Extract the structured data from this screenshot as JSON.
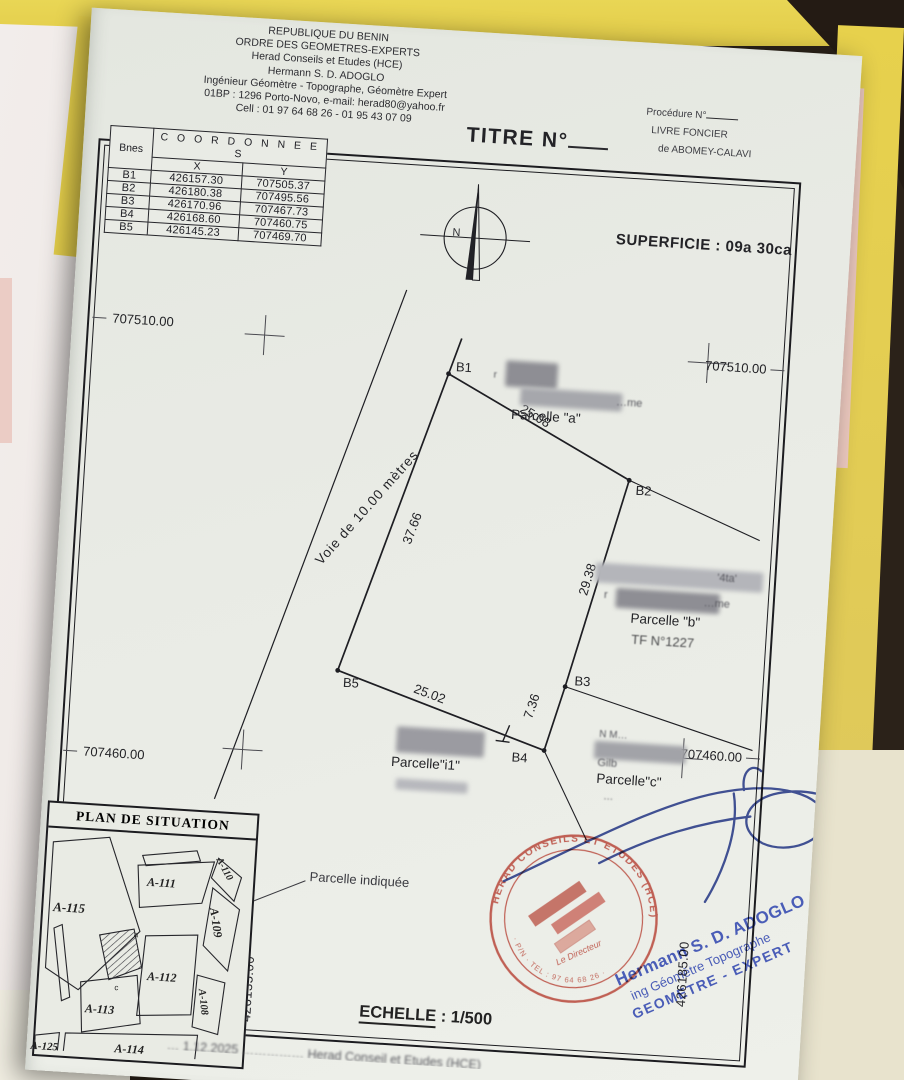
{
  "colors": {
    "sheet": "#e9ebe5",
    "folder_yellow": "#e6d04e",
    "ink": "#1d1d20",
    "stamp_red": "#c23b2e",
    "signature_blue": "#3c55c4"
  },
  "header": {
    "lines": [
      "REPUBLIQUE DU BENIN",
      "ORDRE DES GEOMETRES-EXPERTS",
      "Herad Conseils et Etudes (HCE)",
      "Hermann S. D. ADOGLO",
      "Ingénieur Géomètre - Topographe, Géomètre Expert",
      "01BP : 1296 Porto-Novo, e-mail: herad80@yahoo.fr",
      "Cell : 01 97 64 68 26 - 01 95 43 07 09"
    ]
  },
  "title": {
    "label": "TITRE N°"
  },
  "registry": {
    "procedure": "Procédure N°",
    "livre": "LIVRE FONCIER",
    "place": "de ABOMEY-CALAVI"
  },
  "coordinates": {
    "title": "C O O R D O N N E E S",
    "col_point": "Bnes",
    "col_x": "X",
    "col_y": "Y",
    "rows": [
      [
        "B1",
        "426157.30",
        "707505.37"
      ],
      [
        "B2",
        "426180.38",
        "707495.56"
      ],
      [
        "B3",
        "426170.96",
        "707467.73"
      ],
      [
        "B4",
        "426168.60",
        "707460.75"
      ],
      [
        "B5",
        "426145.23",
        "707469.70"
      ]
    ]
  },
  "superficie": "SUPERFICIE : 09a 30ca",
  "compass": {
    "letter": "N"
  },
  "grid": {
    "y_top": "707510.00",
    "y_bottom": "707460.00",
    "x_left": "426135.00",
    "x_right": "426185.00"
  },
  "parcel": {
    "points": {
      "b1": "B1",
      "b2": "B2",
      "b3": "B3",
      "b4": "B4",
      "b5": "B5"
    },
    "dims": {
      "b1b2": "25.08",
      "b2b3": "29.38",
      "b3b4": "7.36",
      "b4b5": "25.02",
      "b5b1": "37.66"
    },
    "road": "Voie   de   10.00   mètres",
    "a": "Parcelle \"a\"",
    "b": "Parcelle \"b\"",
    "b_tf": "TF N°1227",
    "i1": "Parcelle\"i1\"",
    "c": "Parcelle\"c\"",
    "frag_a": "…me",
    "frag_r": "r",
    "frag_b1": "'4ta'",
    "frag_b2": "…me",
    "frag_c1": "N    M…",
    "frag_c2": "Gilb",
    "frag_c3": "…"
  },
  "situation": {
    "title": "PLAN DE SITUATION",
    "labels": {
      "a115": "A-115",
      "a111": "A-111",
      "a110": "A-110",
      "a109": "A-109",
      "a108": "A-108",
      "a112": "A-112",
      "a113": "A-113",
      "a114": "A-114",
      "a125": "A-125"
    },
    "sub_a": "a",
    "sub_c": "c",
    "note": "Parcelle indiquée"
  },
  "scale": {
    "label": "ECHELLE",
    "sep": " : ",
    "value": "1/500"
  },
  "stamp": {
    "ring": "HERAD CONSEILS ET ETUDES (HCE)",
    "arc": "· P/N · TEL : 97 64 68 26 ·",
    "center": "Le Directeur"
  },
  "signer": {
    "name": "Hermann S. D. ADOGLO",
    "role": "ing Géomètre Topographe",
    "title": "GEOMETRE - EXPERT"
  },
  "bottom_strip": "… 1.12.2025 …………… Herad Conseil et Etudes (HCE)"
}
